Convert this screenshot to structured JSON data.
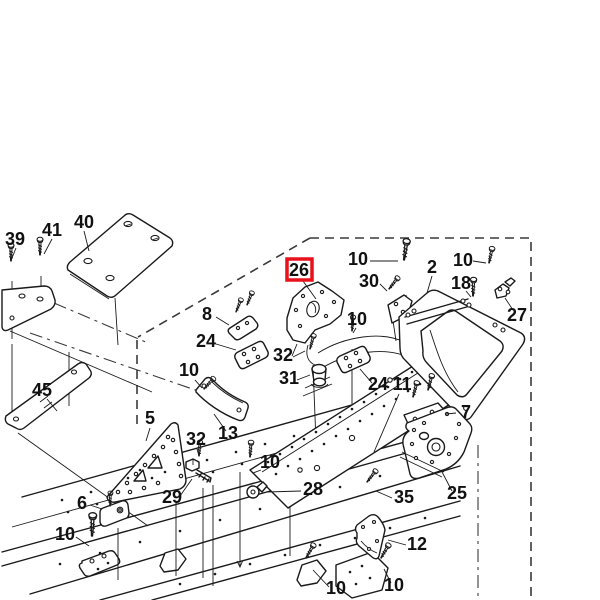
{
  "diagram": {
    "type": "exploded-parts-diagram",
    "highlighted_part": "26",
    "highlight_color": "#e8111c",
    "line_color": "#1a1a1a",
    "background": "#ffffff"
  },
  "callouts": [
    {
      "part": "39"
    },
    {
      "part": "41"
    },
    {
      "part": "40"
    },
    {
      "part": "26",
      "highlighted": true
    },
    {
      "part": "10"
    },
    {
      "part": "30"
    },
    {
      "part": "2"
    },
    {
      "part": "10"
    },
    {
      "part": "18"
    },
    {
      "part": "27"
    },
    {
      "part": "8"
    },
    {
      "part": "24"
    },
    {
      "part": "32"
    },
    {
      "part": "31"
    },
    {
      "part": "10"
    },
    {
      "part": "10"
    },
    {
      "part": "24"
    },
    {
      "part": "11"
    },
    {
      "part": "45"
    },
    {
      "part": "5"
    },
    {
      "part": "32"
    },
    {
      "part": "13"
    },
    {
      "part": "7"
    },
    {
      "part": "6"
    },
    {
      "part": "29"
    },
    {
      "part": "10"
    },
    {
      "part": "28"
    },
    {
      "part": "35"
    },
    {
      "part": "25"
    },
    {
      "part": "12"
    },
    {
      "part": "10"
    },
    {
      "part": "10"
    },
    {
      "part": "10"
    }
  ]
}
